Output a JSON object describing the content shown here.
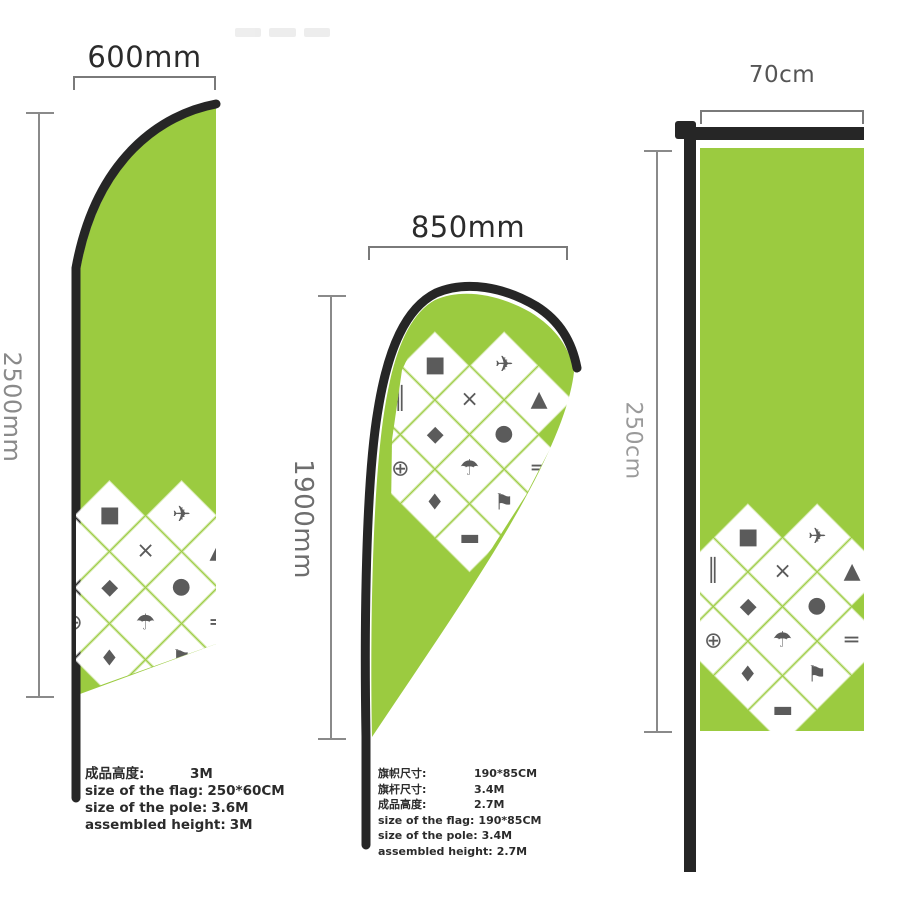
{
  "colors": {
    "flag_green": "#9bcb40",
    "pole_dark": "#262626",
    "dim_line": "#7a7a7a",
    "label_dark": "#2b2b2b",
    "label_gray": "#8a8a8a"
  },
  "flags": {
    "feather": {
      "title": "feather flag",
      "width_label": "600mm",
      "height_label": "2500mm",
      "specs": [
        {
          "label": "成品高度:",
          "value": "3M"
        },
        {
          "label": "size of the flag:",
          "value": "250*60CM"
        },
        {
          "label": "size of the pole:",
          "value": "3.6M"
        },
        {
          "label": "assembled height:",
          "value": "3M"
        }
      ]
    },
    "teardrop": {
      "title": "teardrop flag",
      "width_label": "850mm",
      "height_label": "1900mm",
      "specs": [
        {
          "label": "旗帜尺寸:",
          "value": "190*85CM"
        },
        {
          "label": "旗杆尺寸:",
          "value": "3.4M"
        },
        {
          "label": "成品高度:",
          "value": "2.7M"
        },
        {
          "label": "size of the flag:",
          "value": "190*85CM"
        },
        {
          "label": "size of the pole:",
          "value": "3.4M"
        },
        {
          "label": "assembled height:",
          "value": "2.7M"
        }
      ]
    },
    "rectangle": {
      "title": "rectangle flag",
      "width_label": "70cm",
      "height_label": "250cm"
    }
  },
  "collage": {
    "tiles": [
      {
        "r": 0,
        "c": 1,
        "name": "ground-spike-icon",
        "glyph": "✈"
      },
      {
        "r": 0,
        "c": 2,
        "name": "tent-icon",
        "glyph": "▲"
      },
      {
        "r": 1,
        "c": 0,
        "name": "base-plate-icon",
        "glyph": "■"
      },
      {
        "r": 1,
        "c": 1,
        "name": "cross-base-icon",
        "glyph": "×"
      },
      {
        "r": 1,
        "c": 2,
        "name": "water-bag-icon",
        "glyph": "●"
      },
      {
        "r": 1,
        "c": 3,
        "name": "pole-segment-icon",
        "glyph": "═"
      },
      {
        "r": 2,
        "c": 0,
        "name": "pole-set-icon",
        "glyph": "║"
      },
      {
        "r": 2,
        "c": 1,
        "name": "carry-tube-icon",
        "glyph": "◆"
      },
      {
        "r": 2,
        "c": 2,
        "name": "umbrella-base-icon",
        "glyph": "☂"
      },
      {
        "r": 2,
        "c": 3,
        "name": "flag-kit-icon",
        "glyph": "⚑"
      },
      {
        "r": 3,
        "c": 0,
        "name": "stake-icon",
        "glyph": "+"
      },
      {
        "r": 3,
        "c": 1,
        "name": "rotator-base-icon",
        "glyph": "⊕"
      },
      {
        "r": 3,
        "c": 2,
        "name": "bag-icon",
        "glyph": "♦"
      },
      {
        "r": 3,
        "c": 3,
        "name": "spare-part-icon",
        "glyph": "▬"
      }
    ]
  }
}
